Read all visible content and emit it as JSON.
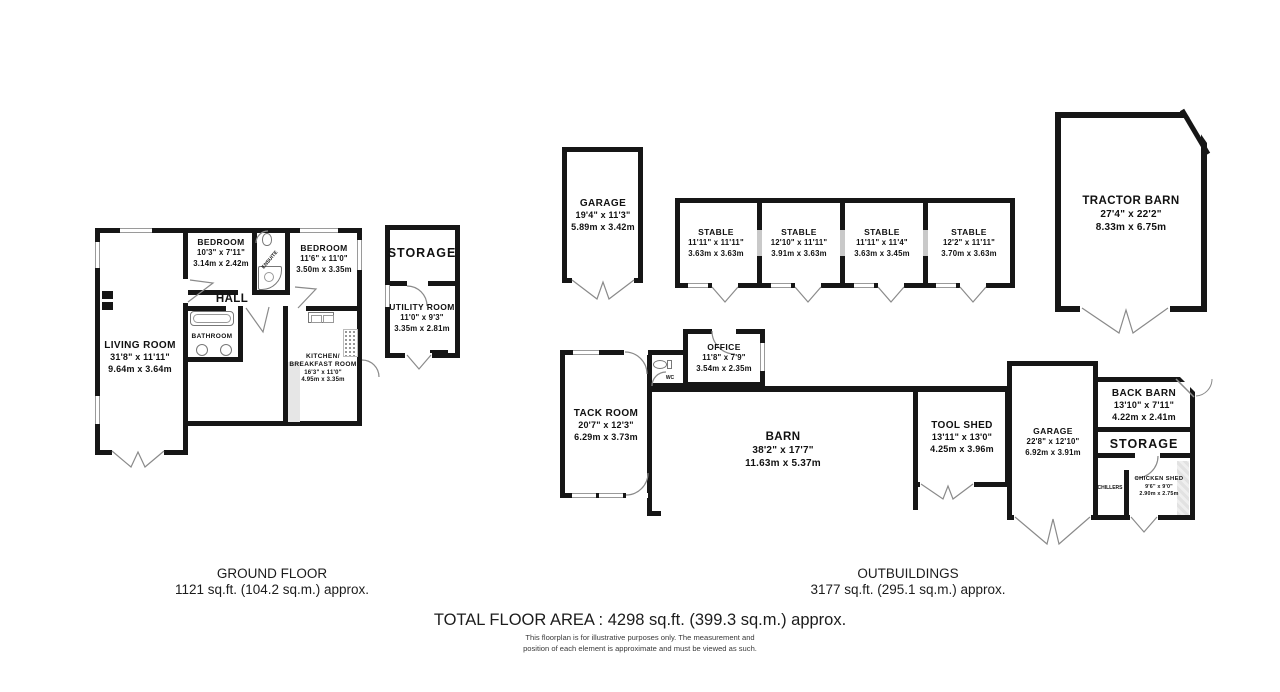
{
  "ground_floor": {
    "section_label": {
      "line1": "GROUND FLOOR",
      "line2": "1121 sq.ft. (104.2 sq.m.) approx."
    },
    "rooms": {
      "living_room": {
        "name": "LIVING ROOM",
        "imperial": "31'8\" x 11'11\"",
        "metric": "9.64m x 3.64m"
      },
      "bedroom_small": {
        "name": "BEDROOM",
        "imperial": "10'3\" x 7'11\"",
        "metric": "3.14m x 2.42m"
      },
      "bedroom_large": {
        "name": "BEDROOM",
        "imperial": "11'6\" x 11'0\"",
        "metric": "3.50m x 3.35m"
      },
      "hall": {
        "name": "HALL"
      },
      "bathroom": {
        "name": "BATHROOM"
      },
      "ensuite": {
        "name": "ENSUITE"
      },
      "kitchen": {
        "name": "KITCHEN/",
        "name2": "BREAKFAST ROOM",
        "imperial": "16'3\" x 11'0\"",
        "metric": "4.95m x 3.35m"
      },
      "storage": {
        "name": "STORAGE"
      },
      "utility": {
        "name": "UTILITY ROOM",
        "imperial": "11'0\" x 9'3\"",
        "metric": "3.35m x 2.81m"
      }
    }
  },
  "outbuildings": {
    "section_label": {
      "line1": "OUTBUILDINGS",
      "line2": "3177 sq.ft. (295.1 sq.m.) approx."
    },
    "rooms": {
      "garage_top": {
        "name": "GARAGE",
        "imperial": "19'4\" x 11'3\"",
        "metric": "5.89m x 3.42m"
      },
      "stables": [
        {
          "name": "STABLE",
          "imperial": "11'11\" x 11'11\"",
          "metric": "3.63m x 3.63m"
        },
        {
          "name": "STABLE",
          "imperial": "12'10\" x 11'11\"",
          "metric": "3.91m x 3.63m"
        },
        {
          "name": "STABLE",
          "imperial": "11'11\" x 11'4\"",
          "metric": "3.63m x 3.45m"
        },
        {
          "name": "STABLE",
          "imperial": "12'2\" x 11'11\"",
          "metric": "3.70m x 3.63m"
        }
      ],
      "tractor_barn": {
        "name": "TRACTOR BARN",
        "imperial": "27'4\" x 22'2\"",
        "metric": "8.33m x 6.75m"
      },
      "office": {
        "name": "OFFICE",
        "imperial": "11'8\" x 7'9\"",
        "metric": "3.54m x 2.35m"
      },
      "wc": {
        "name": "WC"
      },
      "tack_room": {
        "name": "TACK ROOM",
        "imperial": "20'7\" x 12'3\"",
        "metric": "6.29m x 3.73m"
      },
      "barn": {
        "name": "BARN",
        "imperial": "38'2\" x 17'7\"",
        "metric": "11.63m x 5.37m"
      },
      "tool_shed": {
        "name": "TOOL SHED",
        "imperial": "13'11\" x 13'0\"",
        "metric": "4.25m x 3.96m"
      },
      "garage_bottom": {
        "name": "GARAGE",
        "imperial": "22'8\" x 12'10\"",
        "metric": "6.92m x 3.91m"
      },
      "back_barn": {
        "name": "BACK BARN",
        "imperial": "13'10\" x 7'11\"",
        "metric": "4.22m x 2.41m"
      },
      "storage_right": {
        "name": "STORAGE"
      },
      "chillers": {
        "name": "CHILLERS"
      },
      "chicken_shed": {
        "name": "CHICKEN SHED",
        "imperial": "9'6\" x 9'0\"",
        "metric": "2.90m x 2.75m"
      }
    }
  },
  "footer": {
    "total": "TOTAL FLOOR AREA : 4298 sq.ft. (399.3 sq.m.) approx.",
    "disclaimer1": "This floorplan is for illustrative purposes only. The measurement and",
    "disclaimer2": "position of each element is approximate and must be viewed as such."
  },
  "colors": {
    "wall": "#161616",
    "swing_line": "#8a8a8a",
    "hatch": "#e2e2e2"
  }
}
